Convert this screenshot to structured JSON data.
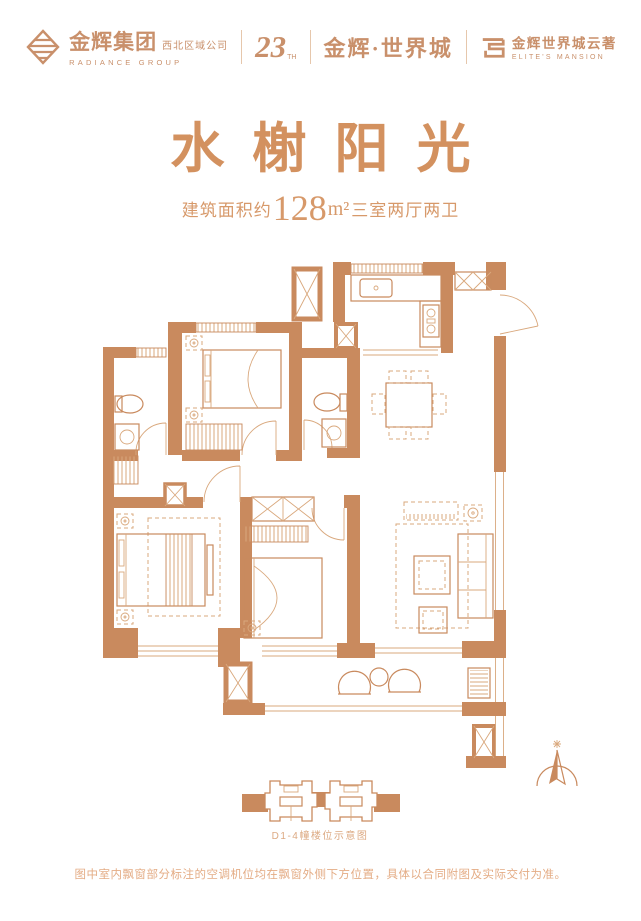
{
  "colors": {
    "accent": "#c98a5e",
    "thin_line": "#d9a87d",
    "title": "#d3915f",
    "footer_text": "#e4ac85"
  },
  "header": {
    "group_logo": {
      "name_cn": "金辉集团",
      "name_en": "RADIANCE GROUP",
      "region": "西北区域公司"
    },
    "anniversary": {
      "number": "23",
      "suffix": "TH"
    },
    "project": "金辉·世界城",
    "sub_brand": {
      "name_cn": "金辉世界城云著",
      "name_en": "ELITE'S MANSION"
    }
  },
  "hero": {
    "title": "水榭阳光",
    "area_label": "建筑面积约",
    "area_value": "128",
    "area_unit": "m²",
    "rooms": "三室两厅两卫"
  },
  "plan": {
    "caption": "D1-4幢楼位示意图"
  },
  "footer": {
    "disclaimer": "图中室内飘窗部分标注的空调机位均在飘窗外侧下方位置，具体以合同附图及实际交付为准。"
  }
}
